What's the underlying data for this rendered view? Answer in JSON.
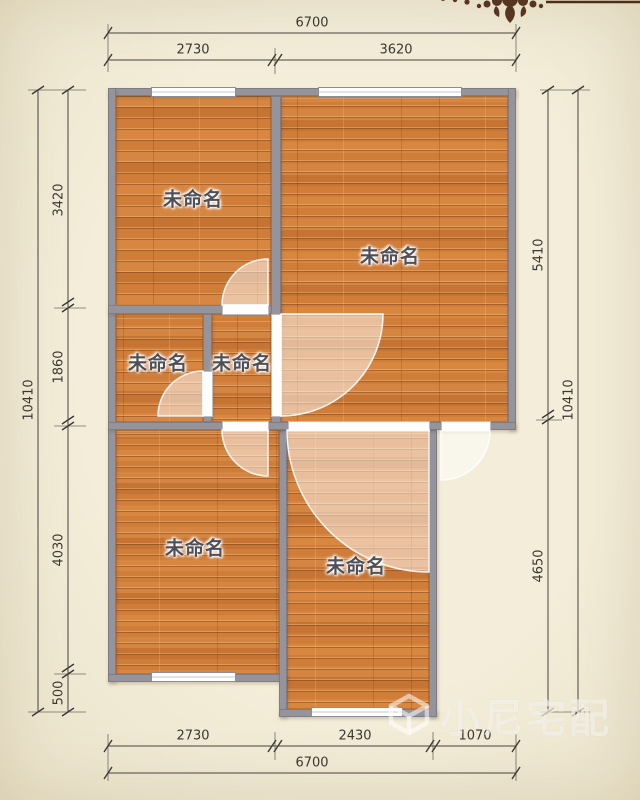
{
  "plan": {
    "type": "floor-plan",
    "rooms": [
      {
        "label": "未命名"
      },
      {
        "label": "未命名"
      },
      {
        "label": "未命名"
      },
      {
        "label": "未命名"
      },
      {
        "label": "未命名"
      },
      {
        "label": "未命名"
      }
    ],
    "dimensions": {
      "top": {
        "overall": "6700",
        "segments": [
          "2730",
          "3620"
        ]
      },
      "bottom": {
        "overall": "6700",
        "segments": [
          "2730",
          "2430",
          "1070"
        ]
      },
      "left": {
        "overall": "10410",
        "segments": [
          "3420",
          "1860",
          "4030",
          "500"
        ]
      },
      "right": {
        "overall": "10410",
        "segments": [
          "5410",
          "4650"
        ]
      }
    },
    "colors": {
      "floor": "#d07d3a",
      "wall": "#95949c",
      "background": "#f1ead6",
      "dimension_text": "#3a3831",
      "ornament": "#4f2d18"
    }
  },
  "watermark": {
    "text": "小尼宅配",
    "icon": "cube-logo-icon"
  }
}
